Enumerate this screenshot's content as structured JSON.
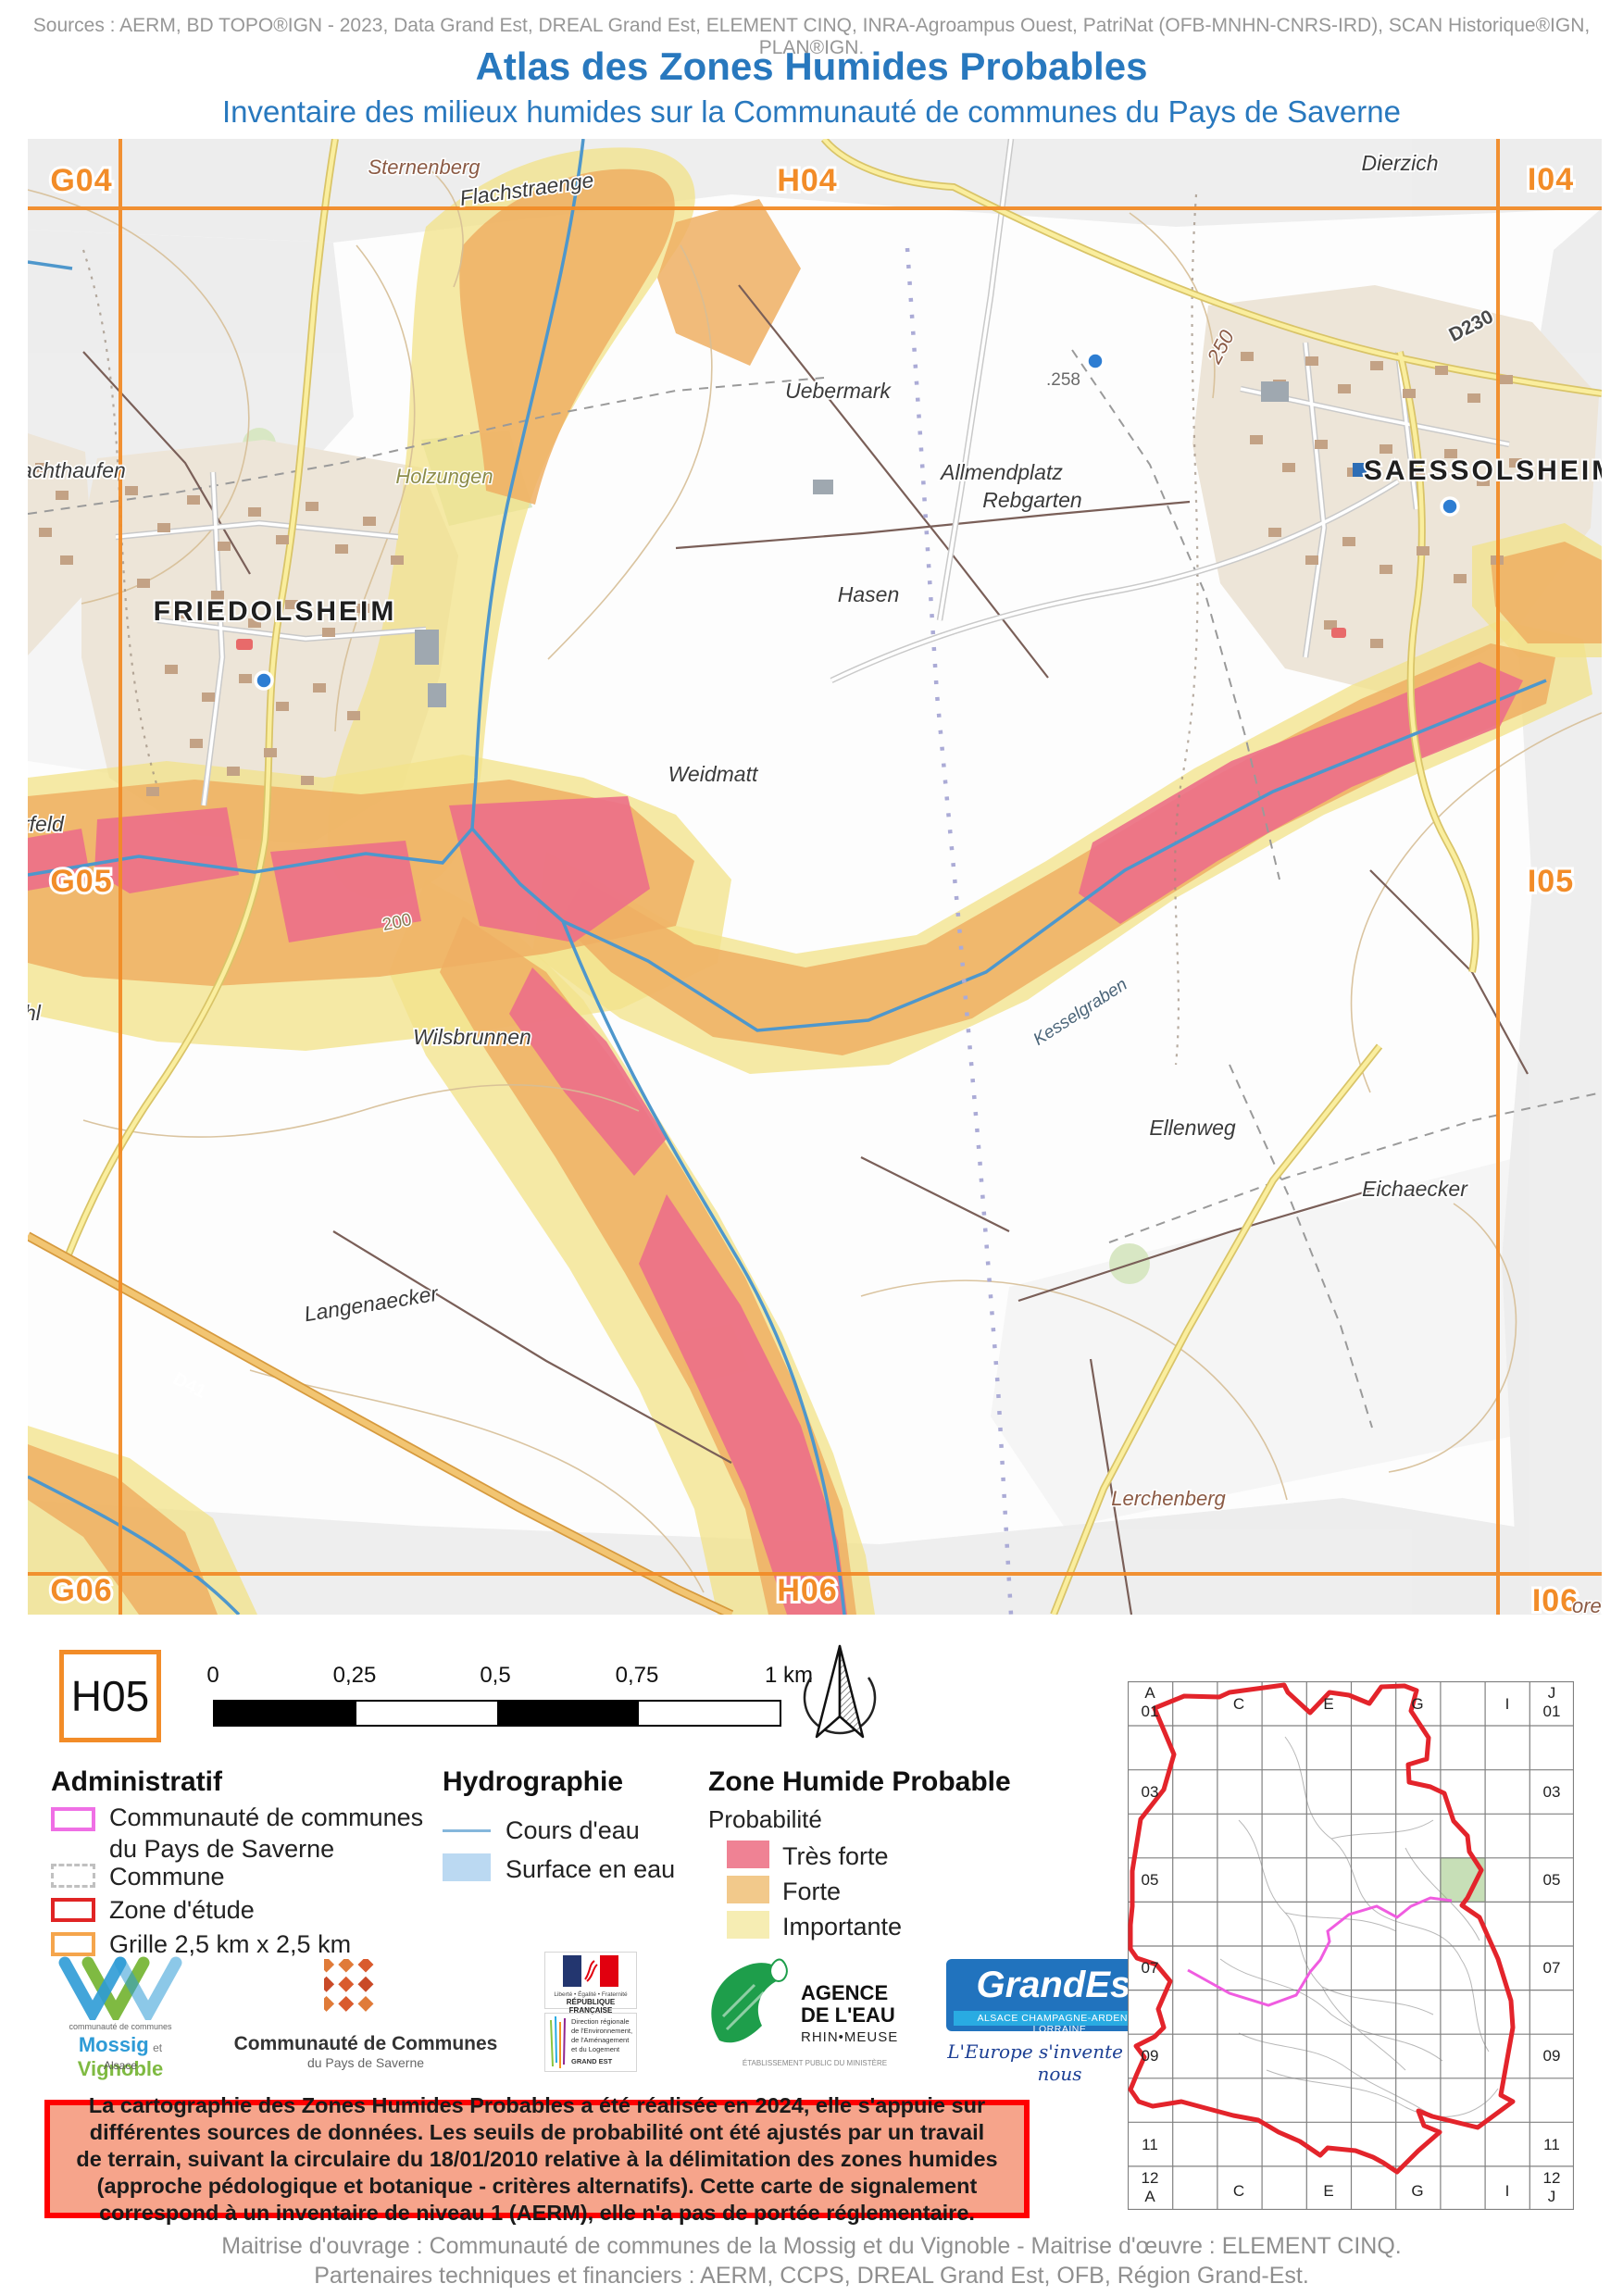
{
  "header": {
    "sources": "Sources : AERM, BD TOPO®IGN - 2023, Data Grand Est, DREAL Grand Est, ELEMENT CINQ, INRA-Agroampus Ouest, PatriNat (OFB-MNHN-CNRS-IRD), SCAN Historique®IGN, PLAN®IGN.",
    "title": "Atlas des Zones Humides Probables",
    "subtitle": "Inventaire des milieux humides sur la Communauté de communes du Pays de Saverne"
  },
  "map": {
    "grid": {
      "g04": "G04",
      "h04": "H04",
      "i04": "I04",
      "g05": "G05",
      "i05": "I05",
      "g06": "G06",
      "h06": "H06",
      "i06": "I06"
    },
    "places": {
      "friedolsheim": "FRIEDOLSHEIM",
      "saessolsheim": "SAESSOLSHEIM",
      "sternenberg": "Sternenberg",
      "flachstraenge": "Flachstraenge",
      "dierzich": "Dierzich",
      "uebermark": "Uebermark",
      "allmendplatz": "Allmendplatz",
      "rebgarten": "Rebgarten",
      "hasen": "Hasen",
      "weidmatt": "Weidmatt",
      "holzungen": "Holzungen",
      "wilsbrunnen": "Wilsbrunnen",
      "ellenweg": "Ellenweg",
      "eichaecker": "Eichaecker",
      "langenaecker": "Langenaecker",
      "lerchenberg": "Lerchenberg",
      "kesselgraben": "Kesselgraben",
      "wachthaufen_partial": "achthaufen",
      "feld_partial": "rfeld",
      "hl_partial": "hl",
      "oren_partial": "oren"
    },
    "roads": {
      "d41": "D41",
      "d230": "D230",
      "r250": "250"
    },
    "elevations": {
      "p258": ".258",
      "c200": "200"
    },
    "colors": {
      "grid": "#F28C28",
      "tres_forte": "#EC6F88",
      "forte": "#EFAF63",
      "importante": "#F2E38C",
      "stream": "#4E97CC"
    }
  },
  "legend": {
    "tile_id": "H05",
    "scalebar_ticks": [
      "0",
      "0,25",
      "0,5",
      "0,75",
      "1 km"
    ],
    "administratif": {
      "title": "Administratif",
      "item1a": "Communauté de communes",
      "item1b": "du Pays de Saverne",
      "item2": "Commune",
      "item3": "Zone d'étude",
      "item4": "Grille 2,5 km x 2,5 km"
    },
    "hydrographie": {
      "title": "Hydrographie",
      "item1": "Cours d'eau",
      "item2": "Surface en eau"
    },
    "zone_humide": {
      "title": "Zone Humide Probable",
      "subtitle": "Probabilité",
      "item1": "Très forte",
      "item2": "Forte",
      "item3": "Importante",
      "colors": {
        "tres_forte": "#EF8294",
        "forte": "#F2C98B",
        "importante": "#F6EDB3"
      }
    }
  },
  "logos": {
    "mossig": {
      "line0": "communauté de communes",
      "name1": "Mossig",
      "name2": "et",
      "name3": "Vignoble",
      "line2": "Alsace"
    },
    "ccps": {
      "line1": "Communauté de Communes",
      "line2": "du Pays de Saverne"
    },
    "republique": {
      "motto": "Liberté • Égalité • Fraternité",
      "name": "RÉPUBLIQUE FRANÇAISE",
      "dreal1": "Direction régionale",
      "dreal2": "de l'Environnement,",
      "dreal3": "de l'Aménagement",
      "dreal4": "et du Logement",
      "dreal5": "GRAND EST"
    },
    "aerm": {
      "line1": "AGENCE",
      "line2": "DE L'EAU",
      "line3": "RHIN•MEUSE",
      "line4": "ÉTABLISSEMENT PUBLIC DU MINISTÈRE"
    },
    "grandest": {
      "name": "GrandEst",
      "strip": "ALSACE CHAMPAGNE-ARDENNE LORRAINE",
      "tagline": "L'Europe s'invente chez nous"
    },
    "elementcinq": {
      "numbers": "1234",
      "five": "5",
      "name1": "élément",
      "name2": "cinq"
    }
  },
  "disclaimer": "La cartographie des Zones Humides Probables a été réalisée en 2024, elle s'appuie sur différentes sources de données. Les seuils de probabilité ont été ajustés par un travail de terrain, suivant la circulaire du 18/01/2010 relative à la délimitation des zones humides (approche pédologique et botanique - critères alternatifs). Cette carte de signalement correspond à un inventaire de niveau 1 (AERM), elle n'a pas de portée réglementaire.",
  "overview": {
    "corner_tl_a": "A",
    "corner_tl_01": "01",
    "corner_tr_j": "J",
    "corner_tr_01": "01",
    "col_c": "C",
    "col_e": "E",
    "col_g": "G",
    "col_i": "I",
    "row_03": "03",
    "row_05": "05",
    "row_07": "07",
    "row_09": "09",
    "row_11": "11",
    "corner_bl_12": "12",
    "corner_bl_a": "A",
    "corner_br_12": "12",
    "corner_br_j": "J"
  },
  "footer": {
    "line1": "Maitrise d'ouvrage : Communauté de communes de la Mossig et du Vignoble - Maitrise d'œuvre : ELEMENT CINQ.",
    "line2": "Partenaires techniques et financiers : AERM, CCPS, DREAL Grand Est, OFB, Région Grand-Est."
  }
}
